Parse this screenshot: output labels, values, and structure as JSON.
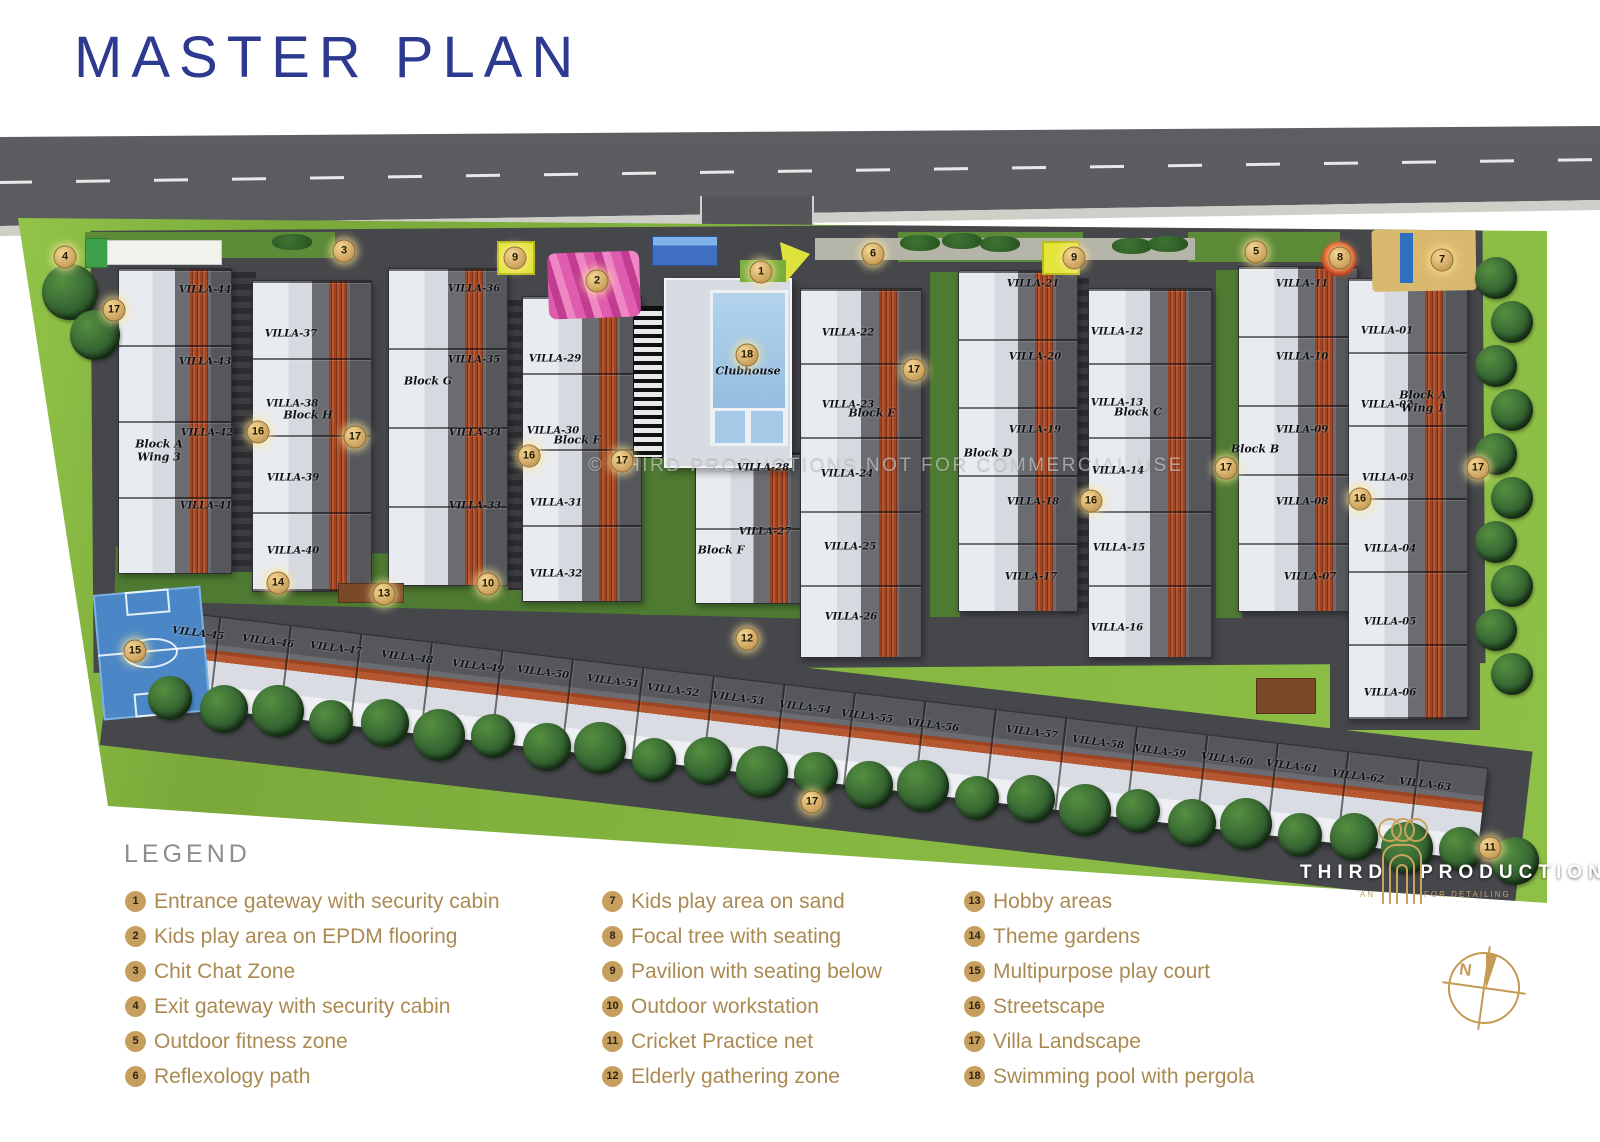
{
  "page": {
    "title": "MASTER PLAN"
  },
  "watermark": "© THIRD PRODUCTIONS NOT FOR COMMERCIAL USE",
  "legend": {
    "heading": "LEGEND",
    "items": [
      {
        "num": "1",
        "label": "Entrance gateway with security cabin"
      },
      {
        "num": "2",
        "label": "Kids play area on EPDM flooring"
      },
      {
        "num": "3",
        "label": "Chit Chat Zone"
      },
      {
        "num": "4",
        "label": "Exit gateway with security cabin"
      },
      {
        "num": "5",
        "label": "Outdoor fitness zone"
      },
      {
        "num": "6",
        "label": "Reflexology path"
      },
      {
        "num": "7",
        "label": "Kids play area on sand"
      },
      {
        "num": "8",
        "label": "Focal tree with seating"
      },
      {
        "num": "9",
        "label": "Pavilion with seating below"
      },
      {
        "num": "10",
        "label": "Outdoor workstation"
      },
      {
        "num": "11",
        "label": "Cricket Practice net"
      },
      {
        "num": "12",
        "label": "Elderly gathering zone"
      },
      {
        "num": "13",
        "label": "Hobby areas"
      },
      {
        "num": "14",
        "label": "Theme gardens"
      },
      {
        "num": "15",
        "label": "Multipurpose play court"
      },
      {
        "num": "16",
        "label": "Streetscape"
      },
      {
        "num": "17",
        "label": "Villa Landscape"
      },
      {
        "num": "18",
        "label": "Swimming pool with pergola"
      }
    ]
  },
  "logo": {
    "word1": "THIRD",
    "word2": "PRODUCTION",
    "sub1": "AN",
    "sub2": "FOR DETAILING"
  },
  "compass": {
    "label": "N"
  },
  "colors": {
    "title_blue": "#2d3a8f",
    "legend_gold": "#ab8a52",
    "badge_gold": "#c69f5e",
    "marker_gold": "#c89d58"
  },
  "plan": {
    "villas": [
      {
        "t": "VILLA-44",
        "x": 205,
        "y": 290
      },
      {
        "t": "VILLA-43",
        "x": 205,
        "y": 362
      },
      {
        "t": "VILLA-42",
        "x": 207,
        "y": 433
      },
      {
        "t": "VILLA-41",
        "x": 206,
        "y": 506
      },
      {
        "t": "VILLA-37",
        "x": 291,
        "y": 334
      },
      {
        "t": "VILLA-38",
        "x": 292,
        "y": 404
      },
      {
        "t": "VILLA-39",
        "x": 293,
        "y": 478
      },
      {
        "t": "VILLA-40",
        "x": 293,
        "y": 551
      },
      {
        "t": "VILLA-36",
        "x": 474,
        "y": 289
      },
      {
        "t": "VILLA-35",
        "x": 474,
        "y": 360
      },
      {
        "t": "VILLA-34",
        "x": 475,
        "y": 433
      },
      {
        "t": "VILLA-33",
        "x": 475,
        "y": 506
      },
      {
        "t": "VILLA-29",
        "x": 555,
        "y": 359
      },
      {
        "t": "VILLA-30",
        "x": 553,
        "y": 431
      },
      {
        "t": "VILLA-31",
        "x": 556,
        "y": 503
      },
      {
        "t": "VILLA-32",
        "x": 556,
        "y": 574
      },
      {
        "t": "VILLA-28",
        "x": 763,
        "y": 468
      },
      {
        "t": "VILLA-27",
        "x": 765,
        "y": 532
      },
      {
        "t": "VILLA-22",
        "x": 848,
        "y": 333
      },
      {
        "t": "VILLA-23",
        "x": 848,
        "y": 405
      },
      {
        "t": "VILLA-24",
        "x": 847,
        "y": 474
      },
      {
        "t": "VILLA-25",
        "x": 850,
        "y": 547
      },
      {
        "t": "VILLA-26",
        "x": 851,
        "y": 617
      },
      {
        "t": "VILLA-21",
        "x": 1033,
        "y": 284
      },
      {
        "t": "VILLA-20",
        "x": 1035,
        "y": 357
      },
      {
        "t": "VILLA-19",
        "x": 1035,
        "y": 430
      },
      {
        "t": "VILLA-18",
        "x": 1033,
        "y": 502
      },
      {
        "t": "VILLA-17",
        "x": 1031,
        "y": 577
      },
      {
        "t": "VILLA-12",
        "x": 1117,
        "y": 332
      },
      {
        "t": "VILLA-13",
        "x": 1117,
        "y": 403
      },
      {
        "t": "VILLA-14",
        "x": 1118,
        "y": 471
      },
      {
        "t": "VILLA-15",
        "x": 1119,
        "y": 548
      },
      {
        "t": "VILLA-16",
        "x": 1117,
        "y": 628
      },
      {
        "t": "VILLA-11",
        "x": 1302,
        "y": 284
      },
      {
        "t": "VILLA-10",
        "x": 1302,
        "y": 357
      },
      {
        "t": "VILLA-09",
        "x": 1302,
        "y": 430
      },
      {
        "t": "VILLA-08",
        "x": 1302,
        "y": 502
      },
      {
        "t": "VILLA-07",
        "x": 1310,
        "y": 577
      },
      {
        "t": "VILLA-01",
        "x": 1387,
        "y": 331
      },
      {
        "t": "VILLA-02",
        "x": 1387,
        "y": 405
      },
      {
        "t": "VILLA-03",
        "x": 1388,
        "y": 478
      },
      {
        "t": "VILLA-04",
        "x": 1390,
        "y": 549
      },
      {
        "t": "VILLA-05",
        "x": 1390,
        "y": 622
      },
      {
        "t": "VILLA-06",
        "x": 1390,
        "y": 693
      },
      {
        "t": "VILLA-45",
        "x": 198,
        "y": 634,
        "r": 7
      },
      {
        "t": "VILLA-46",
        "x": 268,
        "y": 642,
        "r": 7
      },
      {
        "t": "VILLA-47",
        "x": 336,
        "y": 649,
        "r": 7
      },
      {
        "t": "VILLA-48",
        "x": 407,
        "y": 658,
        "r": 7
      },
      {
        "t": "VILLA-49",
        "x": 478,
        "y": 667,
        "r": 7
      },
      {
        "t": "VILLA-50",
        "x": 543,
        "y": 673,
        "r": 7
      },
      {
        "t": "VILLA-51",
        "x": 613,
        "y": 682,
        "r": 7
      },
      {
        "t": "VILLA-52",
        "x": 673,
        "y": 691,
        "r": 7
      },
      {
        "t": "VILLA-53",
        "x": 738,
        "y": 699,
        "r": 7
      },
      {
        "t": "VILLA-54",
        "x": 805,
        "y": 708,
        "r": 7
      },
      {
        "t": "VILLA-55",
        "x": 867,
        "y": 717,
        "r": 7
      },
      {
        "t": "VILLA-56",
        "x": 933,
        "y": 726,
        "r": 7
      },
      {
        "t": "VILLA-57",
        "x": 1032,
        "y": 733,
        "r": 7
      },
      {
        "t": "VILLA-58",
        "x": 1098,
        "y": 743,
        "r": 7
      },
      {
        "t": "VILLA-59",
        "x": 1160,
        "y": 752,
        "r": 7
      },
      {
        "t": "VILLA-60",
        "x": 1227,
        "y": 760,
        "r": 7
      },
      {
        "t": "VILLA-61",
        "x": 1292,
        "y": 767,
        "r": 7
      },
      {
        "t": "VILLA-62",
        "x": 1358,
        "y": 777,
        "r": 7
      },
      {
        "t": "VILLA-63",
        "x": 1425,
        "y": 785,
        "r": 7
      }
    ],
    "blocks": [
      {
        "t": "Block A",
        "t2": "Wing 3",
        "x": 159,
        "y": 451
      },
      {
        "t": "Block H",
        "x": 308,
        "y": 416
      },
      {
        "t": "Block G",
        "x": 428,
        "y": 382
      },
      {
        "t": "Block F",
        "x": 577,
        "y": 441
      },
      {
        "t": "Block F",
        "x": 721,
        "y": 551
      },
      {
        "t": "Block E",
        "x": 872,
        "y": 414
      },
      {
        "t": "Block D",
        "x": 988,
        "y": 454
      },
      {
        "t": "Block C",
        "x": 1138,
        "y": 413
      },
      {
        "t": "Block B",
        "x": 1255,
        "y": 450
      },
      {
        "t": "Block A",
        "t2": "Wing 1",
        "x": 1423,
        "y": 402
      },
      {
        "t": "Clubhouse",
        "x": 748,
        "y": 372
      }
    ],
    "markers": [
      {
        "n": "4",
        "x": 65,
        "y": 257
      },
      {
        "n": "17",
        "x": 114,
        "y": 310
      },
      {
        "n": "3",
        "x": 344,
        "y": 251
      },
      {
        "n": "9",
        "x": 515,
        "y": 258
      },
      {
        "n": "2",
        "x": 597,
        "y": 281
      },
      {
        "n": "1",
        "x": 761,
        "y": 272
      },
      {
        "n": "6",
        "x": 873,
        "y": 254
      },
      {
        "n": "9",
        "x": 1074,
        "y": 258
      },
      {
        "n": "5",
        "x": 1256,
        "y": 252
      },
      {
        "n": "8",
        "x": 1340,
        "y": 258
      },
      {
        "n": "7",
        "x": 1442,
        "y": 260
      },
      {
        "n": "18",
        "x": 747,
        "y": 355
      },
      {
        "n": "17",
        "x": 914,
        "y": 370
      },
      {
        "n": "16",
        "x": 258,
        "y": 432
      },
      {
        "n": "17",
        "x": 355,
        "y": 437
      },
      {
        "n": "16",
        "x": 529,
        "y": 456
      },
      {
        "n": "17",
        "x": 622,
        "y": 461
      },
      {
        "n": "16",
        "x": 1091,
        "y": 501
      },
      {
        "n": "17",
        "x": 1226,
        "y": 468
      },
      {
        "n": "16",
        "x": 1360,
        "y": 499
      },
      {
        "n": "17",
        "x": 1478,
        "y": 468
      },
      {
        "n": "14",
        "x": 278,
        "y": 583
      },
      {
        "n": "13",
        "x": 384,
        "y": 594
      },
      {
        "n": "10",
        "x": 488,
        "y": 584
      },
      {
        "n": "15",
        "x": 135,
        "y": 651
      },
      {
        "n": "12",
        "x": 747,
        "y": 639
      },
      {
        "n": "17",
        "x": 812,
        "y": 802
      },
      {
        "n": "11",
        "x": 1490,
        "y": 848
      }
    ]
  }
}
